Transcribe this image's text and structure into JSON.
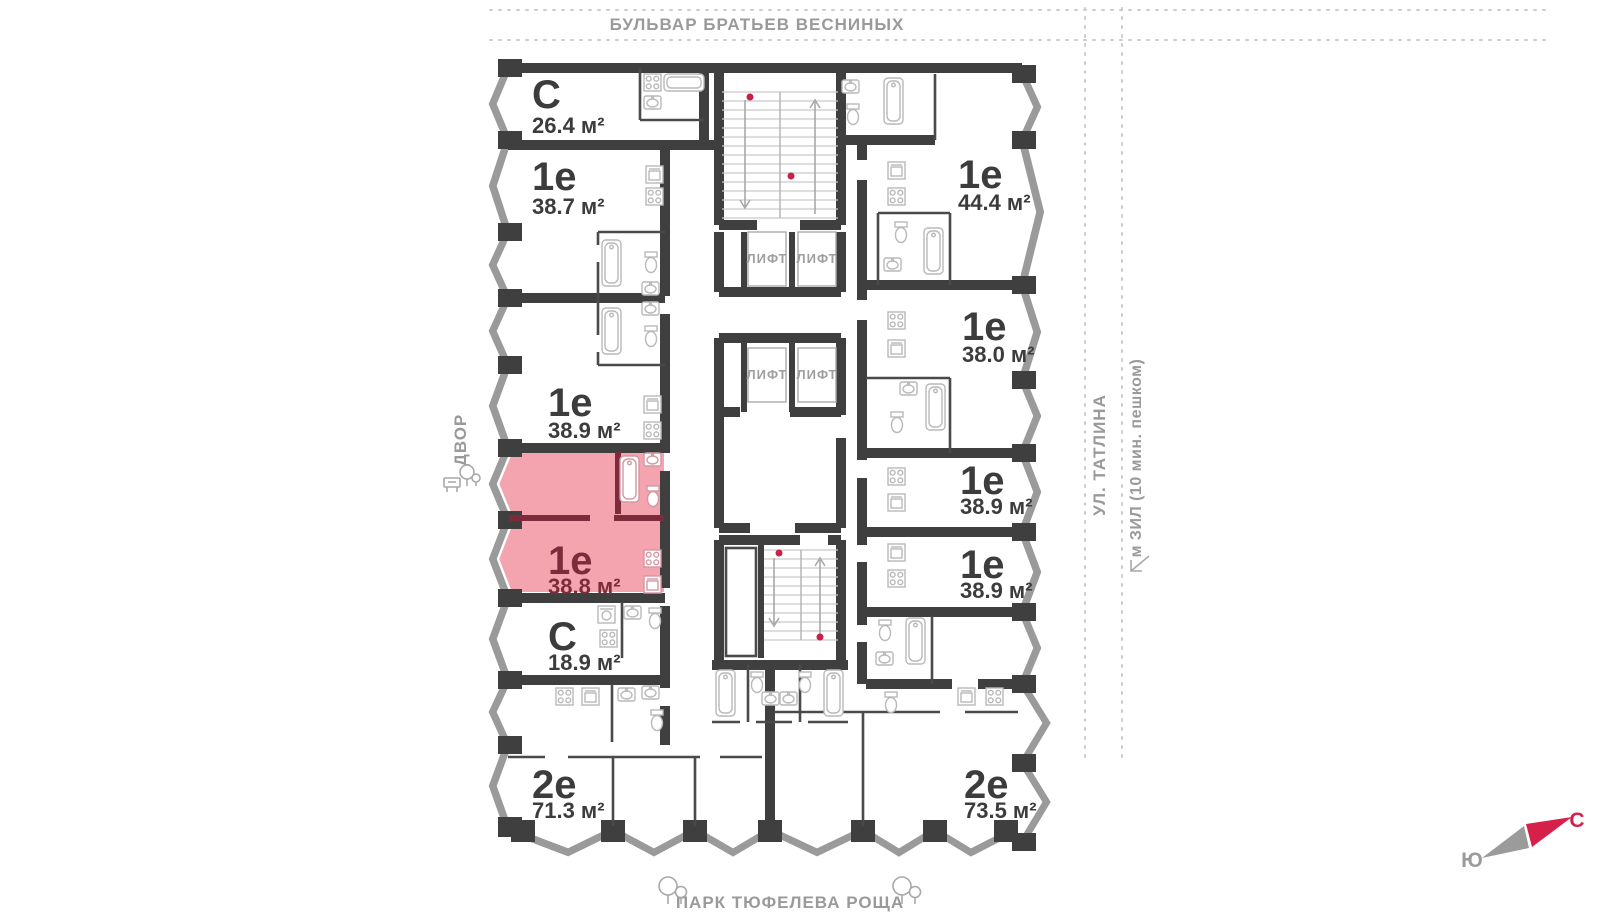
{
  "surroundings": {
    "top_street": "БУЛЬВАР БРАТЬЕВ ВЕСНИНЫХ",
    "bottom_park": "ПАРК ТЮФЕЛЕВА РОЩА",
    "left_yard": "ДВОР",
    "right_street": "УЛ. ТАТЛИНА",
    "right_metro": "м ЗИЛ (10 мин. пешком)"
  },
  "compass": {
    "north_label": "С",
    "south_label": "Ю"
  },
  "core": {
    "elevator_label": "ЛИФТ",
    "elevator_count": 4
  },
  "apartments": [
    {
      "id": "left-1",
      "type": "С",
      "area": "26.4 м²",
      "highlighted": false
    },
    {
      "id": "left-2",
      "type": "1е",
      "area": "38.7 м²",
      "highlighted": false
    },
    {
      "id": "left-3",
      "type": "1е",
      "area": "38.9 м²",
      "highlighted": false
    },
    {
      "id": "left-4",
      "type": "1е",
      "area": "38.8 м²",
      "highlighted": true
    },
    {
      "id": "left-5",
      "type": "С",
      "area": "18.9 м²",
      "highlighted": false
    },
    {
      "id": "left-6",
      "type": "2е",
      "area": "71.3 м²",
      "highlighted": false
    },
    {
      "id": "right-1",
      "type": "1е",
      "area": "44.4 м²",
      "highlighted": false
    },
    {
      "id": "right-2",
      "type": "1е",
      "area": "38.0 м²",
      "highlighted": false
    },
    {
      "id": "right-3",
      "type": "1е",
      "area": "38.9 м²",
      "highlighted": false
    },
    {
      "id": "right-4",
      "type": "1е",
      "area": "38.9 м²",
      "highlighted": false
    },
    {
      "id": "right-5",
      "type": "2е",
      "area": "73.5 м²",
      "highlighted": false
    }
  ],
  "colors": {
    "wall": "#3f3f3f",
    "bay_glazing": "#9a9a9a",
    "highlight_fill": "#f3a4ae",
    "highlight_wall": "#7d2b3a",
    "label_text": "#3c3c3c",
    "street_text": "#9a9a9a",
    "fixture": "#b9b9b9",
    "compass_north": "#d6204a",
    "compass_south": "#9b9b9b",
    "stair_dot": "#c92045"
  }
}
